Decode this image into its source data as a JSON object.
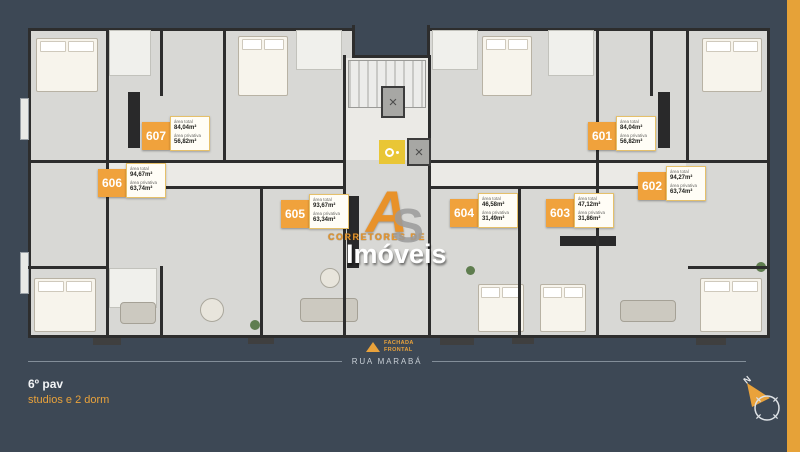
{
  "plan": {
    "area_total_label": "área total",
    "area_privativa_label": "área privativa",
    "units": [
      {
        "number": "601",
        "area_total": "84,04m²",
        "area_privativa": "56,82m²"
      },
      {
        "number": "602",
        "area_total": "94,27m²",
        "area_privativa": "63,74m²"
      },
      {
        "number": "603",
        "area_total": "47,12m²",
        "area_privativa": "31,86m²"
      },
      {
        "number": "604",
        "area_total": "46,58m²",
        "area_privativa": "31,49m²"
      },
      {
        "number": "605",
        "area_total": "93,67m²",
        "area_privativa": "63,34m²"
      },
      {
        "number": "606",
        "area_total": "94,67m²",
        "area_privativa": "63,74m²"
      },
      {
        "number": "607",
        "area_total": "84,04m²",
        "area_privativa": "56,82m²"
      }
    ]
  },
  "watermark": {
    "letter_a": "A",
    "letter_s": "S",
    "line1": "CORRETORES DE",
    "line2": "Imóveis"
  },
  "facade": {
    "line1": "FACHADA",
    "line2": "FRONTAL"
  },
  "street": {
    "name": "RUA MARABÁ"
  },
  "footer": {
    "floor": "6º pav",
    "subtitle": "studios e 2 dorm"
  },
  "compass": {
    "north": "N"
  },
  "colors": {
    "background": "#3d4855",
    "accent_orange": "#e6a238",
    "unit_label_orange": "#f0a23c",
    "plan_floor": "#d8d8d5",
    "wall": "#2d2d2d",
    "elevator_yellow": "#e9c636"
  }
}
